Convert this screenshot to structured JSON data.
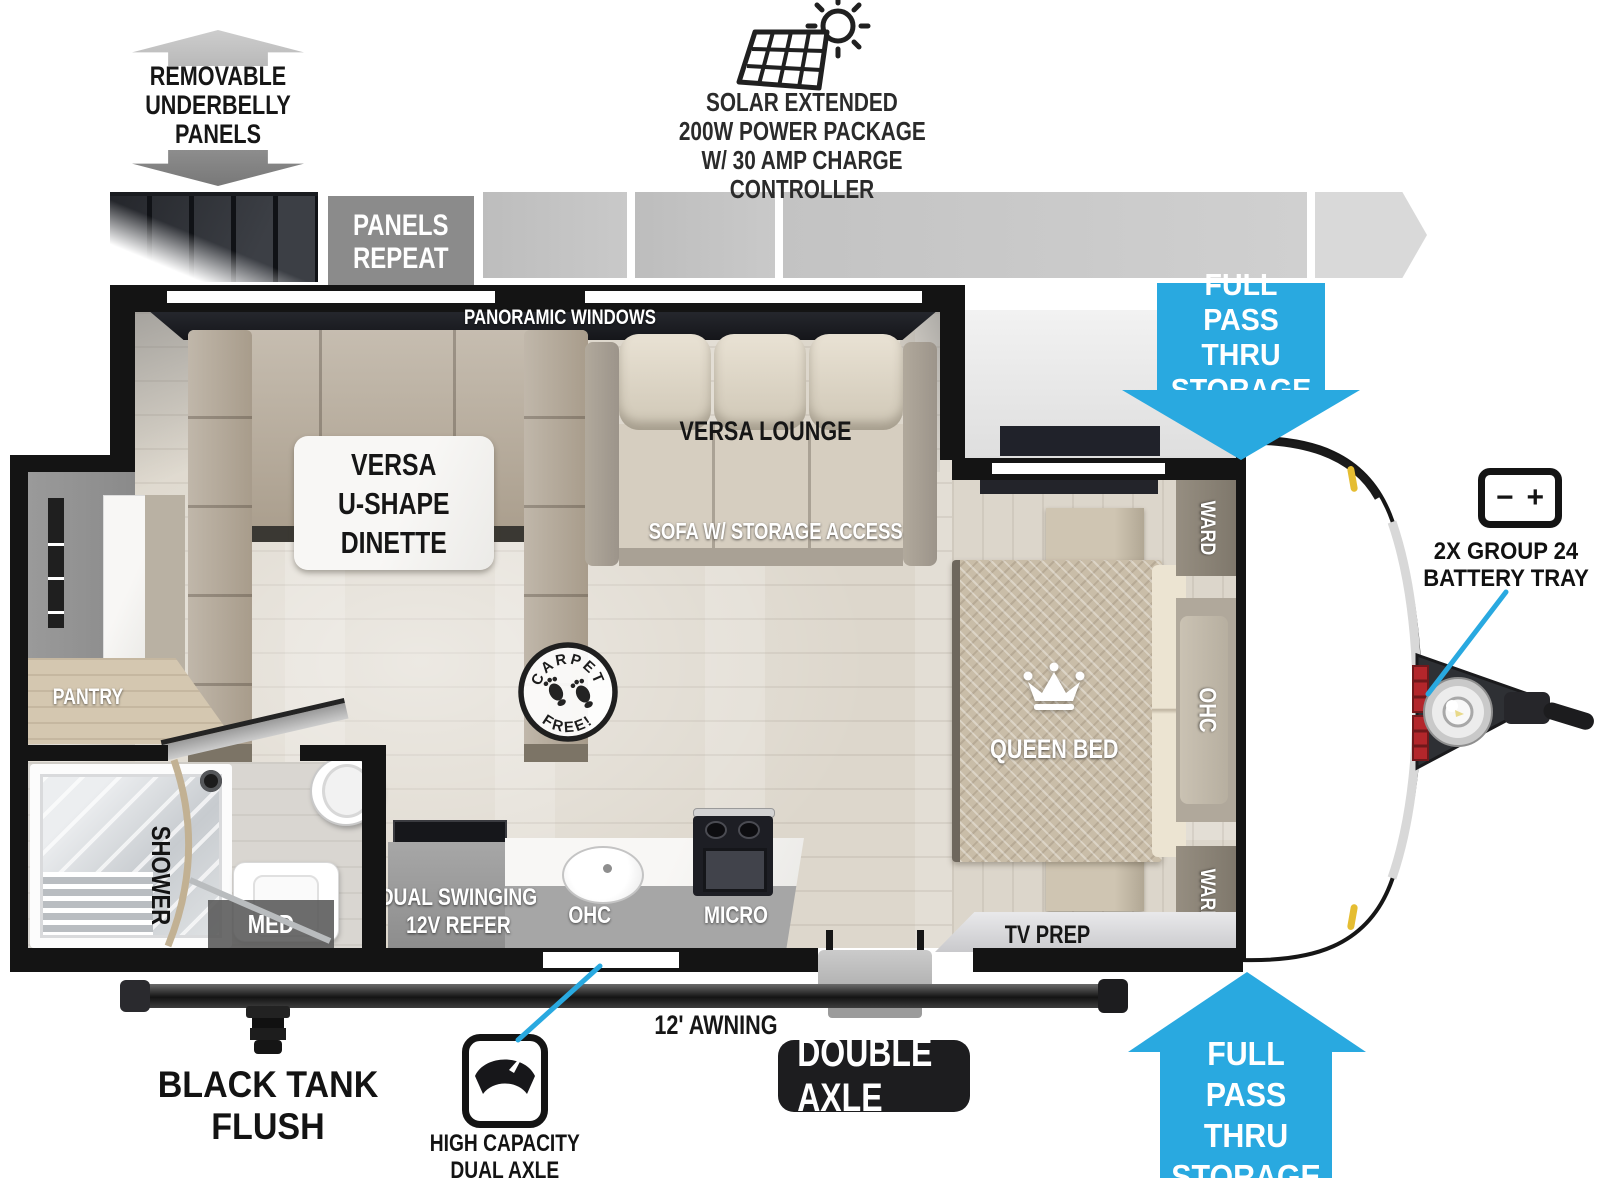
{
  "colors": {
    "accent_blue": "#29a9e0",
    "wall_black": "#141414"
  },
  "underbelly": {
    "title": "REMOVABLE\nUNDERBELLY\nPANELS",
    "panels_repeat": "PANELS\nREPEAT"
  },
  "solar": {
    "line1": "SOLAR EXTENDED",
    "line2": "200W POWER PACKAGE",
    "line3": "W/ 30 AMP CHARGE CONTROLLER"
  },
  "pass_thru": {
    "top": "FULL PASS\nTHRU\nSTORAGE",
    "bottom": "FULL PASS\nTHRU\nSTORAGE"
  },
  "interior": {
    "panoramic_windows": "PANORAMIC WINDOWS",
    "dinette": "VERSA\nU-SHAPE\nDINETTE",
    "versa_lounge": "VERSA LOUNGE",
    "sofa_storage": "SOFA W/ STORAGE ACCESS",
    "queen_bed": "QUEEN BED",
    "ward_front": "WARD",
    "ward_rear": "WARD",
    "ohc_bedroom": "OHC",
    "tv_prep": "TV PREP",
    "pantry": "PANTRY",
    "shower": "SHOWER",
    "med": "MED",
    "refer": "DUAL SWINGING\n12V REFER",
    "ohc_kitchen": "OHC",
    "micro": "MICRO",
    "carpet_free": {
      "top": "CARPET",
      "bottom": "FREE!"
    }
  },
  "exterior": {
    "battery_label": "2X GROUP 24\nBATTERY TRAY",
    "battery_minus": "−",
    "battery_plus": "+",
    "black_tank_flush": "BLACK TANK FLUSH",
    "awning": "12' AWNING",
    "double_axle": "DOUBLE AXLE",
    "high_capacity": "HIGH CAPACITY\nDUAL AXLE"
  }
}
